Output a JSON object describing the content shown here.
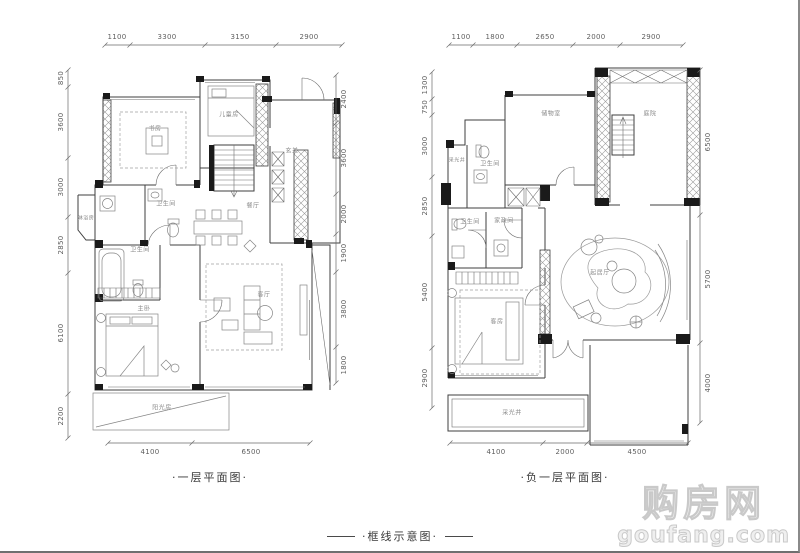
{
  "captions": {
    "left_plan_title": "·一层平面图·",
    "right_plan_title": "·负一层平面图·",
    "footer_label": "·框线示意图·"
  },
  "watermark": {
    "cn": "购房网",
    "en": "goufang.com"
  },
  "colors": {
    "wall": "#3f3f3f",
    "black_wall": "#1a1a1a",
    "dim_text": "#5f5f5f",
    "room_text": "#8a8a8a",
    "caption_text": "#3a3a3a",
    "watermark": "#e9e9e9"
  },
  "left_plan": {
    "top_dims": [
      "1100",
      "3300",
      "3150",
      "2900"
    ],
    "left_dims": [
      "850",
      "3600",
      "3000",
      "2850",
      "6100",
      "2200"
    ],
    "right_dims": [
      "2400",
      "3600",
      "2000",
      "1900",
      "3800",
      "1800"
    ],
    "bottom_dims": [
      "4100",
      "6500"
    ],
    "rooms": {
      "study": "书房",
      "kids": "儿童房",
      "foyer": "玄关",
      "bath1": "卫生间",
      "shower": "淋浴房",
      "bath2": "卫生间",
      "dining": "餐厅",
      "master": "主卧",
      "living": "客厅",
      "sunroom": "阳光房"
    }
  },
  "right_plan": {
    "top_dims": [
      "1100",
      "1800",
      "2650",
      "2000",
      "2900"
    ],
    "left_dims": [
      "1300",
      "750",
      "3000",
      "2850",
      "5400",
      "2900"
    ],
    "right_dims": [
      "6500",
      "5700",
      "4000"
    ],
    "bottom_dims": [
      "4100",
      "2000",
      "4500"
    ],
    "rooms": {
      "lightwell1": "采光井",
      "bath1": "卫生间",
      "storage": "储物室",
      "courtyard": "庭院",
      "bath2": "卫生间",
      "utility": "家政间",
      "guest": "客房",
      "lounge": "起居厅",
      "lightwell2": "采光井"
    }
  }
}
